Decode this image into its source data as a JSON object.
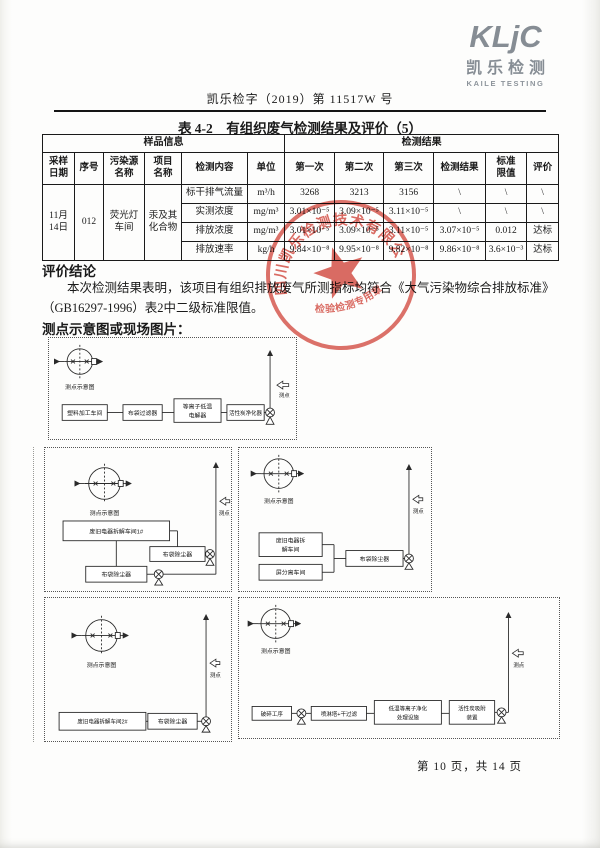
{
  "header": {
    "logo_mark": "KLjC",
    "logo_cn": "凯乐检测",
    "logo_en": "KAILE TESTING",
    "doc_number": "凯乐检字（2019）第 11517W 号"
  },
  "table": {
    "title": "表 4-2　有组织废气检测结果及评价（5）",
    "groups": {
      "sample": "样品信息",
      "result": "检测结果"
    },
    "headers": [
      "采样\n日期",
      "序号",
      "污染源\n名称",
      "项目\n名称",
      "检测内容",
      "单位",
      "第一次",
      "第二次",
      "第三次",
      "检测结果",
      "标准\n限值",
      "评价"
    ],
    "sample": {
      "date": "11月\n14日",
      "serial": "012",
      "source": "荧光灯\n车间",
      "project": "汞及其\n化合物"
    },
    "rows": [
      [
        "标干排气流量",
        "m³/h",
        "3268",
        "3213",
        "3156",
        "\\",
        "\\",
        "\\"
      ],
      [
        "实测浓度",
        "mg/m³",
        "3.01×10⁻⁵",
        "3.09×10⁻⁵",
        "3.11×10⁻⁵",
        "\\",
        "\\",
        "\\"
      ],
      [
        "排放浓度",
        "mg/m³",
        "3.01×10⁻⁵",
        "3.09×10⁻⁵",
        "3.11×10⁻⁵",
        "3.07×10⁻⁵",
        "0.012",
        "达标"
      ],
      [
        "排放速率",
        "kg/h",
        "9.84×10⁻⁸",
        "9.95×10⁻⁸",
        "9.82×10⁻⁸",
        "9.86×10⁻⁸",
        "3.6×10⁻³",
        "达标"
      ]
    ]
  },
  "evaluation": {
    "heading": "评价结论",
    "body": "本次检测结果表明，该项目有组织排放废气所测指标均符合《大气污染物综合排放标准》（GB16297-1996）表2中二级标准限值。",
    "diagram_heading": "测点示意图或现场图片："
  },
  "stamp": {
    "company": "四川凯乐检测技术有限公司",
    "subtitle": "检验检测专用章",
    "color": "#cf3a2e"
  },
  "diagrams": [
    {
      "compass": "测点示意图",
      "point": "测点",
      "boxes": [
        [
          "塑料加工车间"
        ],
        [
          "布袋过滤器"
        ],
        [
          "等离子低温",
          "电解器"
        ],
        [
          "活性炭净化器"
        ]
      ]
    },
    {
      "compass": "测点示意图",
      "point": "测点",
      "boxes": [
        [
          "废旧电器拆解车间1#"
        ],
        [
          "布袋除尘器"
        ],
        [
          "布袋除尘器"
        ]
      ]
    },
    {
      "compass": "测点示意图",
      "point": "测点",
      "boxes": [
        [
          "废旧电器拆",
          "解车间"
        ],
        [
          "屏分离车间"
        ],
        [
          "布袋除尘器"
        ]
      ]
    },
    {
      "compass": "测点示意图",
      "point": "测点",
      "boxes": [
        [
          "废旧电器拆解车间2#"
        ],
        [
          "布袋除尘器"
        ]
      ]
    },
    {
      "compass": "测点示意图",
      "point": "测点",
      "boxes": [
        [
          "破碎工序"
        ],
        [
          "喷淋塔+干过滤"
        ],
        [
          "低温等离子净化",
          "处理设施"
        ],
        [
          "活性炭吸附",
          "装置"
        ]
      ]
    }
  ],
  "footer": {
    "page_info": "第 10 页，共 14 页"
  }
}
